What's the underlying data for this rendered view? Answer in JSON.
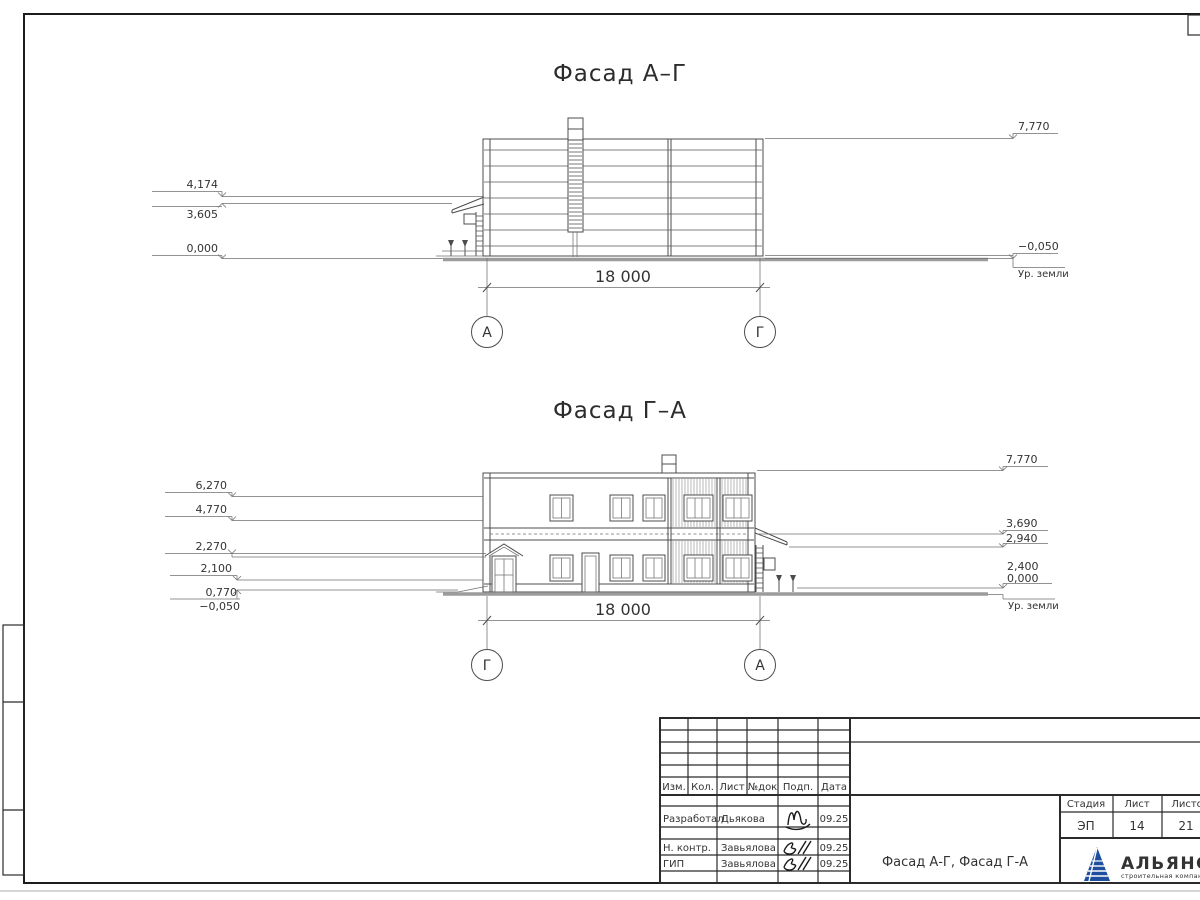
{
  "drawing": {
    "facade_ag": {
      "title": "Фасад А–Г",
      "dim": "18 000",
      "axis_left": "А",
      "axis_right": "Г",
      "marks_left": [
        "4,174",
        "3,605",
        "0,000"
      ],
      "marks_right": [
        "7,770",
        "−0,050"
      ],
      "ground_label": "Ур. земли"
    },
    "facade_ga": {
      "title": "Фасад Г–А",
      "dim": "18 000",
      "axis_left": "Г",
      "axis_right": "А",
      "marks_left": [
        "6,270",
        "4,770",
        "2,270",
        "2,100",
        "0,770",
        "−0,050"
      ],
      "marks_right": [
        "7,770",
        "3,690",
        "2,940",
        "2,400",
        "0,000"
      ],
      "ground_label": "Ур. земли"
    }
  },
  "titleblock": {
    "headers": [
      "Изм.",
      "Кол.",
      "Лист",
      "№док",
      "Подп.",
      "Дата"
    ],
    "rows": [
      {
        "role": "Разработал",
        "name": "Дьякова",
        "date": "09.25"
      },
      {
        "role": "Н. контр.",
        "name": "Завьялова",
        "date": "09.25"
      },
      {
        "role": "ГИП",
        "name": "Завьялова",
        "date": "09.25"
      }
    ],
    "doc_title": "Фасад А-Г, Фасад Г-А",
    "stage_label": "Стадия",
    "sheet_label": "Лист",
    "sheets_label": "Листов",
    "stage": "ЭП",
    "sheet_no": "14",
    "sheets_total": "21",
    "company": "АЛЬЯНС",
    "company_sub": "строительная компания"
  },
  "colors": {
    "logo_blue": "#1d4f9e",
    "logo_red": "#e23c2a"
  }
}
